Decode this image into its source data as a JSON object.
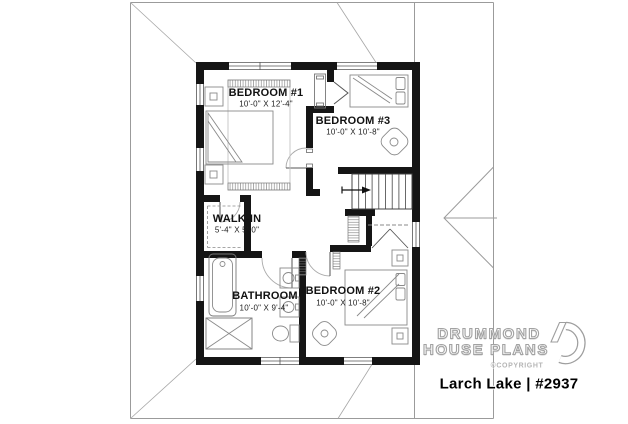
{
  "plan": {
    "rooms": [
      {
        "id": "bedroom1",
        "name": "BEDROOM #1",
        "dims": "10'-0\" X 12'-4\""
      },
      {
        "id": "bedroom3",
        "name": "BEDROOM #3",
        "dims": "10'-0\" X 10'-8\""
      },
      {
        "id": "walkin",
        "name": "WALK-IN",
        "dims": "5'-4\" X 5'-0\""
      },
      {
        "id": "bathroom",
        "name": "BATHROOM",
        "dims": "10'-0\" X 9'-4\""
      },
      {
        "id": "bedroom2",
        "name": "BEDROOM #2",
        "dims": "10'-0\" X 10'-8\""
      }
    ]
  },
  "branding": {
    "company_line1": "DRUMMOND",
    "company_line2": "HOUSE PLANS",
    "copyright": "©COPYRIGHT",
    "plan_title": "Larch Lake | #2937",
    "logo_icon": "drummond-d-icon"
  },
  "colors": {
    "wall": "#151515",
    "furniture_line": "#8a8a8a",
    "roof_line": "#9b9b9b",
    "text": "#111111"
  }
}
